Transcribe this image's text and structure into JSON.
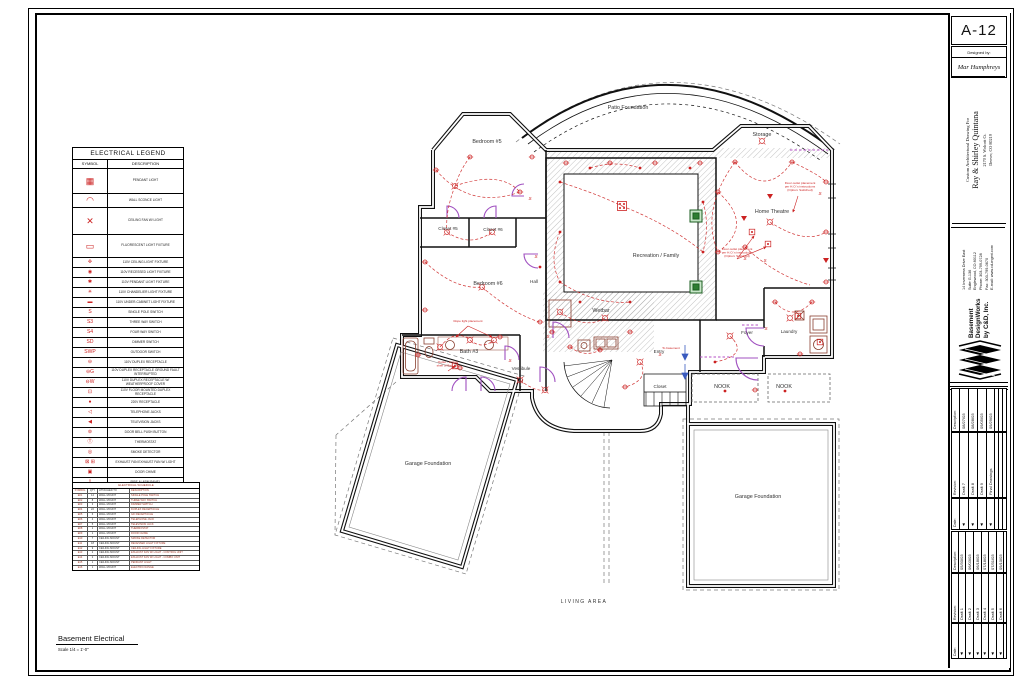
{
  "colors": {
    "electrical_red": "#cc2222",
    "door_purple": "#a050c0",
    "column_green": "#2e7d32",
    "wall_black": "#111111",
    "fixture_brown": "#8a4030",
    "note_blue": "#3a5bbf"
  },
  "sheet": {
    "number": "A-12",
    "designed_by_label": "Designed by:",
    "designer": "Mar Humphreys",
    "client": {
      "line1": "Custom Architectural Drawing For",
      "line2": "Ray & Shirley Quintana",
      "line3": "2170 S. Wolcott Ct.",
      "line4": "Denver, CO 80219"
    },
    "company": {
      "name_lines": [
        "Basement",
        "DesignWorks",
        "by C&D, Inc."
      ],
      "address_lines": [
        "14 Inverness Drive East",
        "Suite G-136",
        "Englewood, CO 80112",
        "Phone: 303-799-0728",
        "Fax: 303-799-0670",
        "E-mail: www.cd-mgmt.com"
      ]
    },
    "rev_labels": {
      "date": "Date:",
      "revision": "Revision:",
      "description": "Description:"
    },
    "revisions_recent": [
      {
        "rev": "Draft 7",
        "date": "08/27/03"
      },
      {
        "rev": "Draft 8",
        "date": "08/28/03"
      },
      {
        "rev": "Draft 9",
        "date": "09/05/03"
      },
      {
        "rev": "Final Drawings",
        "date": "09/29/03"
      }
    ],
    "revisions_initial": [
      {
        "rev": "Draft 1",
        "date": "05/30/03"
      },
      {
        "rev": "Draft 2",
        "date": "06/03/03"
      },
      {
        "rev": "Draft 3",
        "date": "06/18/03"
      },
      {
        "rev": "Draft 4",
        "date": "07/18/03"
      },
      {
        "rev": "Draft 5",
        "date": "07/31/03"
      },
      {
        "rev": "Draft 6",
        "date": "09/10/03"
      }
    ]
  },
  "drawing_title": {
    "name": "Basement Electrical",
    "scale": "Scale 1/4 = 1'-0\""
  },
  "legend": {
    "title": "ELECTRICAL LEGEND",
    "col_symbol": "SYMBOL",
    "col_description": "DESCRIPTION",
    "rows": [
      {
        "glyph": "▦",
        "desc": "PENDANT LIGHT",
        "h": 24,
        "big": true
      },
      {
        "glyph": "◠",
        "desc": "WALL SCONCE LIGHT",
        "h": 13,
        "big": true
      },
      {
        "glyph": "✕",
        "desc": "CEILING FAN W/ LIGHT",
        "h": 26,
        "big": true
      },
      {
        "glyph": "▭",
        "desc": "FLUORESCENT LIGHT FIXTURE",
        "h": 22,
        "big": true
      },
      {
        "glyph": "✜",
        "desc": "110V CEILING LIGHT FIXTURE",
        "h": 9
      },
      {
        "glyph": "◉",
        "desc": "110V RECESSED LIGHT FIXTURE",
        "h": 9
      },
      {
        "glyph": "✱",
        "desc": "110V PENDANT LIGHT FIXTURE",
        "h": 9
      },
      {
        "glyph": "✳",
        "desc": "110V CHANDELIER LIGHT FIXTURE",
        "h": 9
      },
      {
        "glyph": "▬",
        "desc": "110V UNDER-CABINET LIGHT FIXTURE",
        "h": 9
      },
      {
        "glyph": "S",
        "desc": "SINGLE POLE SWITCH",
        "h": 9
      },
      {
        "glyph": "S3",
        "desc": "THREE WAY SWITCH",
        "h": 9
      },
      {
        "glyph": "S4",
        "desc": "FOUR WAY SWITCH",
        "h": 9
      },
      {
        "glyph": "SD",
        "desc": "DIMMER SWITCH",
        "h": 9
      },
      {
        "glyph": "SWP",
        "desc": "OUTDOOR SWITCH",
        "h": 9
      },
      {
        "glyph": "⊖",
        "desc": "110V DUPLEX RECEPTACLE",
        "h": 9
      },
      {
        "glyph": "⊖G",
        "desc": "110V DUPLEX RECEPTACLE GROUND FAULT INTERRUPTED",
        "h": 9
      },
      {
        "glyph": "⊖W",
        "desc": "110V DUPLEX RECEPTACLE W/ WEATHERPROOF COVER",
        "h": 9
      },
      {
        "glyph": "⊡",
        "desc": "110V FLOOR MOUNTED DUPLEX RECEPTACLE",
        "h": 9
      },
      {
        "glyph": "●",
        "desc": "220V  RECEPTACLE",
        "h": 9
      },
      {
        "glyph": "◁",
        "desc": "TELEPHONE JACKS",
        "h": 9
      },
      {
        "glyph": "◀",
        "desc": "TELEVISION JACKS",
        "h": 9
      },
      {
        "glyph": "⊚",
        "desc": "DOOR BELL PUSH BUTTON",
        "h": 9
      },
      {
        "glyph": "Ⓣ",
        "desc": "THERMOSTAT",
        "h": 9
      },
      {
        "glyph": "◎",
        "desc": "SMOKE DETECTOR",
        "h": 9
      },
      {
        "glyph": "⊠ ⊞",
        "desc": "EXHAUST FAN      EXHAUST FAN W/ LIGHT",
        "h": 9
      },
      {
        "glyph": "▣",
        "desc": "DOOR CHIME",
        "h": 9
      },
      {
        "glyph": "▯",
        "desc": "FIRE ALARM PANEL",
        "h": 9
      },
      {
        "glyph": "⌀",
        "desc": "COMPUTER POINT",
        "h": 9
      }
    ]
  },
  "schedule": {
    "title": "ELECTRICAL SCHEDULE",
    "columns": [
      "SYMBOL",
      "QTY",
      "ATTACHED TO",
      "DESCRIPTION"
    ],
    "rows": [
      [
        "E01",
        "14",
        "WALL MOUNT",
        "SINGLE POLE SWITCH"
      ],
      [
        "E02",
        "8",
        "WALL MOUNT",
        "THREE WAY SWITCH"
      ],
      [
        "E03",
        "3",
        "WALL MOUNT",
        "DIMMER SWITCH"
      ],
      [
        "E04",
        "22",
        "WALL MOUNT",
        "DUPLEX RECEPTACLE"
      ],
      [
        "E05",
        "6",
        "WALL MOUNT",
        "GFI RECEPTACLE"
      ],
      [
        "E06",
        "4",
        "WALL MOUNT",
        "TELEPHONE JACK"
      ],
      [
        "E07",
        "5",
        "WALL MOUNT",
        "TELEVISION JACK"
      ],
      [
        "E08",
        "1",
        "WALL MOUNT",
        "THERMOSTAT"
      ],
      [
        "E09",
        "1",
        "WALL MOUNT",
        "DOOR CHIME"
      ],
      [
        "E10",
        "7",
        "CEILING MOUNT",
        "SMOKE DETECTOR"
      ],
      [
        "E11",
        "18",
        "CEILING MOUNT",
        "RECESSED LIGHT FIXTURE"
      ],
      [
        "E12",
        "9",
        "CEILING MOUNT",
        "CEILING LIGHT FIXTURE"
      ],
      [
        "E13",
        "2",
        "CEILING MOUNT",
        "EXHAUST FAN W/ LIGHT - CONTROL UNIT"
      ],
      [
        "E14",
        "2",
        "CEILING MOUNT",
        "EXHAUST FAN W/ LIGHT - COMBO UNIT"
      ],
      [
        "E15",
        "1",
        "CEILING MOUNT",
        "PENDANT LIGHT"
      ],
      [
        "E16",
        "1",
        "WALL MOUNT",
        "ELECTRIC RANGE"
      ]
    ]
  },
  "plan": {
    "rooms": [
      {
        "label": "Patio Foundation",
        "x": 628,
        "y": 109
      },
      {
        "label": "Bedroom #5",
        "x": 487,
        "y": 143
      },
      {
        "label": "Storage",
        "x": 762,
        "y": 136
      },
      {
        "label": "Home Theatre",
        "x": 772,
        "y": 213
      },
      {
        "label": "Recreation / Family",
        "x": 656,
        "y": 257
      },
      {
        "label": "Closet #5",
        "x": 448,
        "y": 230,
        "small": true
      },
      {
        "label": "Closet #6",
        "x": 493,
        "y": 231,
        "small": true
      },
      {
        "label": "Bedroom #6",
        "x": 488,
        "y": 285
      },
      {
        "label": "Hall",
        "x": 534,
        "y": 283,
        "small": true
      },
      {
        "label": "Wetbar",
        "x": 601,
        "y": 312
      },
      {
        "label": "Bath #3",
        "x": 469,
        "y": 353
      },
      {
        "label": "Vestibule",
        "x": 521,
        "y": 370,
        "small": true
      },
      {
        "label": "Entry",
        "x": 659,
        "y": 353,
        "small": true
      },
      {
        "label": "Closet",
        "x": 660,
        "y": 388,
        "small": true
      },
      {
        "label": "NOOK",
        "x": 722,
        "y": 388
      },
      {
        "label": "NOOK",
        "x": 784,
        "y": 388
      },
      {
        "label": "Foyer",
        "x": 747,
        "y": 334,
        "small": true
      },
      {
        "label": "Laundry",
        "x": 789,
        "y": 333,
        "small": true
      },
      {
        "label": "Garage Foundation",
        "x": 428,
        "y": 465
      },
      {
        "label": "Garage Foundation",
        "x": 758,
        "y": 498
      },
      {
        "label": "LIVING AREA",
        "x": 584,
        "y": 603,
        "wide": true
      }
    ],
    "annotations": [
      {
        "x": 800,
        "y": 184,
        "lines": [
          "Floor outlet placement",
          "per H.O.'s instructions",
          "(Option: Switched)"
        ],
        "arrows": [
          [
            798,
            196,
            793,
            212
          ]
        ]
      },
      {
        "x": 737,
        "y": 250,
        "lines": [
          "Floor outlet placement",
          "per H.O.'s instructions",
          "(Option: Switched)"
        ],
        "arrows": [
          [
            737,
            259,
            754,
            236
          ],
          [
            737,
            259,
            766,
            247
          ]
        ]
      },
      {
        "x": 468,
        "y": 322,
        "lines": [
          "Rope light placement"
        ],
        "arrows": [
          [
            468,
            326,
            456,
            337
          ],
          [
            468,
            326,
            492,
            337
          ]
        ]
      },
      {
        "x": 448,
        "y": 363,
        "lines": [
          "Outlet - bottom",
          "shelf of Bed Cab"
        ],
        "arrows": [
          [
            448,
            371,
            455,
            366
          ]
        ]
      },
      {
        "x": 671,
        "y": 349,
        "lines": [
          "To basement"
        ],
        "arrows": []
      }
    ],
    "symbols": [
      [
        "cl",
        455,
        186
      ],
      [
        "cl",
        447,
        232
      ],
      [
        "cl",
        492,
        232
      ],
      [
        "cl",
        482,
        287
      ],
      [
        "cl",
        440,
        347
      ],
      [
        "cl",
        470,
        340
      ],
      [
        "cl",
        494,
        340
      ],
      [
        "cl",
        520,
        380
      ],
      [
        "cl",
        560,
        312
      ],
      [
        "cl",
        605,
        318
      ],
      [
        "cl",
        640,
        362
      ],
      [
        "cl",
        730,
        336
      ],
      [
        "cl",
        770,
        222
      ],
      [
        "cl",
        790,
        318
      ],
      [
        "cl",
        762,
        141
      ],
      [
        "cl",
        545,
        390
      ],
      [
        "pl",
        622,
        206
      ],
      [
        "rc",
        436,
        170
      ],
      [
        "rc",
        520,
        192
      ],
      [
        "rc",
        470,
        157
      ],
      [
        "rc",
        532,
        157
      ],
      [
        "rc",
        566,
        163
      ],
      [
        "rc",
        610,
        163
      ],
      [
        "rc",
        655,
        163
      ],
      [
        "rc",
        700,
        163
      ],
      [
        "rc",
        425,
        262
      ],
      [
        "rc",
        425,
        310
      ],
      [
        "rc",
        540,
        322
      ],
      [
        "rc",
        500,
        337
      ],
      [
        "rc",
        418,
        355
      ],
      [
        "rc",
        735,
        162
      ],
      [
        "rc",
        792,
        162
      ],
      [
        "rc",
        826,
        182
      ],
      [
        "rc",
        826,
        232
      ],
      [
        "rc",
        826,
        282
      ],
      [
        "rc",
        718,
        192
      ],
      [
        "rc",
        718,
        252
      ],
      [
        "rc",
        745,
        247
      ],
      [
        "rc",
        570,
        347
      ],
      [
        "rc",
        600,
        350
      ],
      [
        "rc",
        630,
        332
      ],
      [
        "rc",
        552,
        332
      ],
      [
        "rc",
        625,
        387
      ],
      [
        "rc",
        775,
        302
      ],
      [
        "rc",
        812,
        302
      ],
      [
        "rc",
        800,
        354
      ],
      [
        "rc",
        755,
        390
      ],
      [
        "rc",
        460,
        368
      ],
      [
        "rl",
        560,
        182
      ],
      [
        "rl",
        560,
        232
      ],
      [
        "rl",
        560,
        282
      ],
      [
        "rl",
        590,
        168
      ],
      [
        "rl",
        640,
        168
      ],
      [
        "rl",
        690,
        168
      ],
      [
        "rl",
        703,
        202
      ],
      [
        "rl",
        703,
        252
      ],
      [
        "rl",
        630,
        302
      ],
      [
        "rl",
        580,
        302
      ],
      [
        "rl",
        540,
        267
      ],
      [
        "rl",
        715,
        362
      ],
      [
        "rl",
        725,
        391
      ],
      [
        "rl",
        785,
        391
      ],
      [
        "sw",
        530,
        200
      ],
      [
        "sw",
        536,
        258
      ],
      [
        "sw",
        510,
        362
      ],
      [
        "sw",
        548,
        338
      ],
      [
        "sw",
        660,
        356
      ],
      [
        "sw",
        766,
        330
      ],
      [
        "sw",
        745,
        260
      ],
      [
        "sw",
        765,
        262
      ],
      [
        "sw",
        820,
        195
      ],
      [
        "fx",
        752,
        232
      ],
      [
        "fx",
        768,
        244
      ],
      [
        "fx",
        820,
        342
      ],
      [
        "fx",
        798,
        316
      ],
      [
        "fx",
        455,
        366
      ],
      [
        "tri",
        744,
        218
      ],
      [
        "tri",
        770,
        196
      ],
      [
        "tri",
        826,
        260
      ]
    ],
    "wires": [
      "M436,170 Q470,210 520,192",
      "M455,186 Q500,170 520,192",
      "M470,157 Q460,170 455,186",
      "M447,232 Q470,248 492,232",
      "M455,186 Q445,212 447,232",
      "M425,262 Q455,290 482,287",
      "M482,287 Q515,315 540,322",
      "M440,347 Q455,328 470,340",
      "M470,340 Q482,350 494,340",
      "M560,182 Q600,195 622,206",
      "M622,206 Q670,225 703,252",
      "M560,282 Q595,305 630,302",
      "M560,232 Q548,260 560,282",
      "M590,168 Q615,160 640,168",
      "M703,202 Q710,225 703,252",
      "M735,162 Q765,200 792,162",
      "M718,192 Q755,225 718,252",
      "M770,222 Q805,245 826,232",
      "M745,247 Q775,275 810,285",
      "M792,162 Q820,175 826,182",
      "M735,162 Q700,210 718,252",
      "M560,312 Q585,330 605,318",
      "M570,347 Q585,358 600,350",
      "M775,302 Q793,322 812,302",
      "M730,336 Q750,355 715,362",
      "M520,380 Q535,392 545,390",
      "M640,362 Q650,380 625,387"
    ],
    "doors": [
      "M447,218 L447,206 A12,12 0 0 1 459,218",
      "M496,218 L496,206 A12,12 0 0 0 484,218",
      "M524,196 L512,196 A12,12 0 0 1 524,184",
      "M538,254 L524,254 A14,14 0 0 0 538,268",
      "M505,360 L505,346 A14,14 0 0 1 519,360",
      "M481,391 L481,377 A14,14 0 0 1 495,391",
      "M466,391 L466,377 A14,14 0 0 0 452,391",
      "M540,382 L540,367 A15,15 0 0 1 555,382",
      "M553,338 L553,322 A16,16 0 0 1 569,338",
      "M764,328 L746,328 A18,18 0 0 0 764,346",
      "M758,358 L736,358 A22,22 0 0 0 758,380"
    ],
    "openings": [
      "M700,357 H734",
      "M742,325 H760",
      "M790,150 H828"
    ]
  }
}
